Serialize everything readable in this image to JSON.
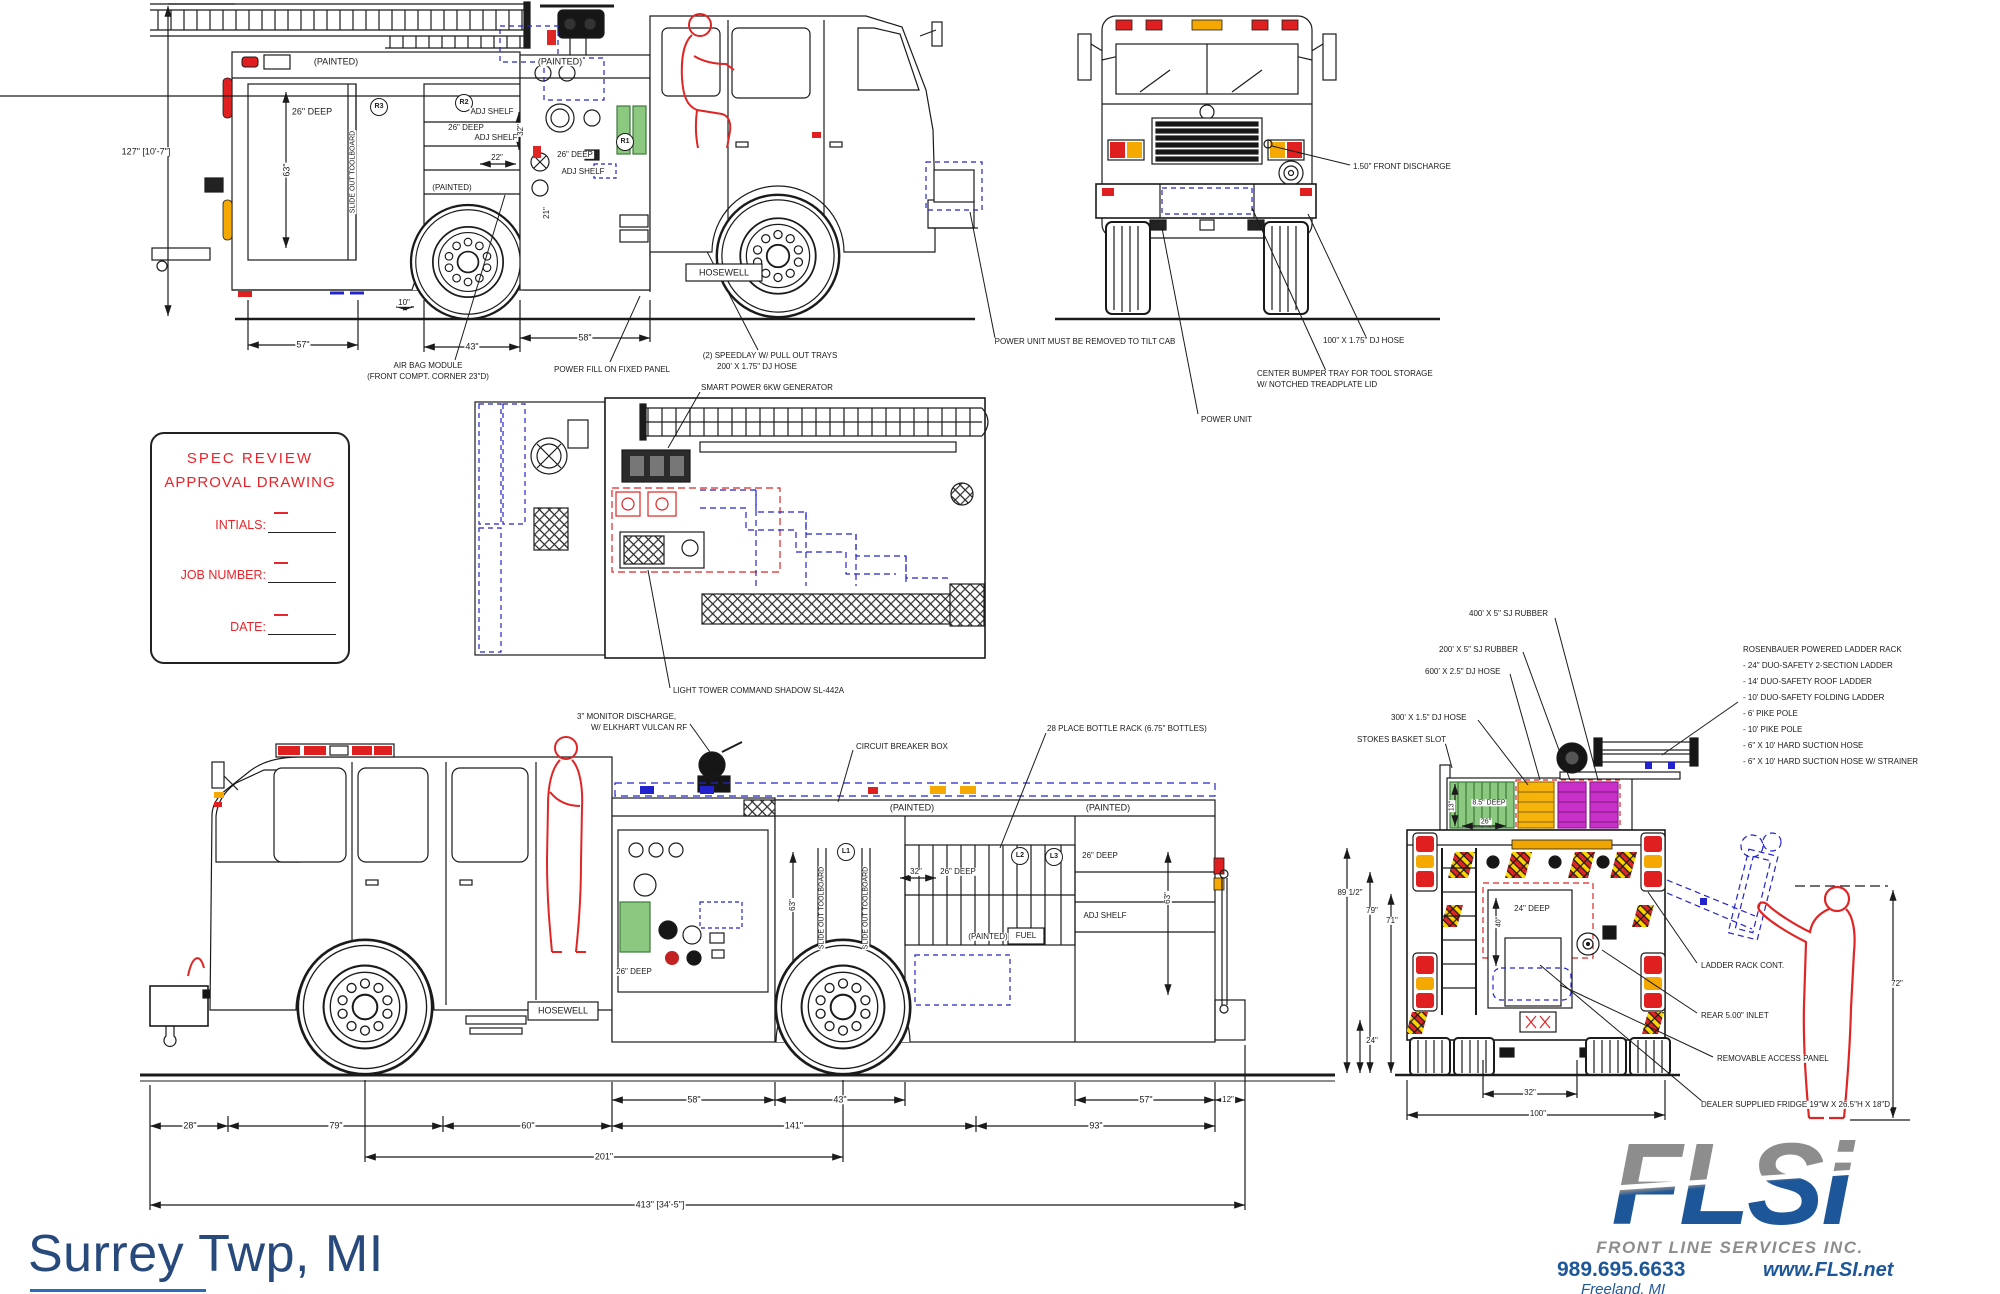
{
  "sheet": {
    "title": "Surrey Twp,  MI"
  },
  "spec_box": {
    "title1": "SPEC  REVIEW",
    "title2": "APPROVAL  DRAWING",
    "fields": [
      {
        "label": "INTIALS:"
      },
      {
        "label": "JOB  NUMBER:"
      },
      {
        "label": "DATE:"
      }
    ]
  },
  "logo": {
    "acronym": "FLSi",
    "company": "FRONT LINE SERVICES INC.",
    "phone": "989.695.6633",
    "website": "www.FLSI.net",
    "city": "Freeland, MI"
  },
  "colors": {
    "accent_red": "#e8252a",
    "cad_blue": "#2323cd",
    "hose_green": "#8cc87f",
    "hose_orange": "#f6b40a",
    "hose_magenta": "#c92fc9",
    "logo_blue": "#1e5799",
    "logo_gray": "#8d8d8d",
    "title_blue": "#27497c"
  },
  "labels": [
    {
      "t": "127\" [10'-7\"]",
      "x": 146,
      "y": 152
    },
    {
      "t": "(PAINTED)",
      "x": 336,
      "y": 62
    },
    {
      "t": "(PAINTED)",
      "x": 560,
      "y": 62
    },
    {
      "t": "26\" DEEP",
      "x": 312,
      "y": 112
    },
    {
      "t": "63\"",
      "x": 287,
      "y": 170,
      "r": -90
    },
    {
      "t": "SLIDE OUT TOOLBOARD",
      "x": 353,
      "y": 172,
      "r": -90,
      "fs": 7
    },
    {
      "t": "R3",
      "x": 379,
      "y": 107,
      "circ": 1,
      "fs": 7
    },
    {
      "t": "R2",
      "x": 464,
      "y": 103,
      "circ": 1,
      "fs": 7
    },
    {
      "t": "ADJ SHELF",
      "x": 492,
      "y": 112,
      "fs": 8
    },
    {
      "t": "26\" DEEP",
      "x": 466,
      "y": 128,
      "fs": 8
    },
    {
      "t": "ADJ SHELF",
      "x": 496,
      "y": 138,
      "fs": 8
    },
    {
      "t": "32\"",
      "x": 521,
      "y": 130,
      "r": -90,
      "fs": 8
    },
    {
      "t": "22\"",
      "x": 497,
      "y": 158,
      "fs": 8
    },
    {
      "t": "26\" DEEP",
      "x": 575,
      "y": 155,
      "fs": 8
    },
    {
      "t": "ADJ SHELF",
      "x": 583,
      "y": 172,
      "fs": 8
    },
    {
      "t": "(PAINTED)",
      "x": 452,
      "y": 188,
      "fs": 8
    },
    {
      "t": "21\"",
      "x": 547,
      "y": 213,
      "r": -90,
      "fs": 8
    },
    {
      "t": "R1",
      "x": 625,
      "y": 142,
      "circ": 1,
      "fs": 7
    },
    {
      "t": "10\"",
      "x": 404,
      "y": 303,
      "fs": 8
    },
    {
      "t": "57\"",
      "x": 303,
      "y": 345
    },
    {
      "t": "43\"",
      "x": 472,
      "y": 347
    },
    {
      "t": "58\"",
      "x": 585,
      "y": 338
    },
    {
      "t": "AIR BAG MODULE",
      "x": 428,
      "y": 366,
      "fs": 8
    },
    {
      "t": "(FRONT COMPT. CORNER 23\"D)",
      "x": 428,
      "y": 377,
      "fs": 8
    },
    {
      "t": "POWER FILL ON FIXED PANEL",
      "x": 612,
      "y": 370,
      "fs": 8
    },
    {
      "t": "HOSEWELL",
      "x": 724,
      "y": 273,
      "fs": 9
    },
    {
      "t": "(2) SPEEDLAY W/ PULL OUT TRAYS",
      "x": 770,
      "y": 356,
      "fs": 8
    },
    {
      "t": "200' X 1.75\" DJ HOSE",
      "x": 757,
      "y": 367,
      "fs": 8
    },
    {
      "t": "POWER UNIT MUST BE REMOVED TO TILT CAB",
      "x": 1085,
      "y": 342,
      "fs": 8
    },
    {
      "t": "1.50\" FRONT DISCHARGE",
      "x": 1352,
      "y": 167,
      "a": "l",
      "fs": 8
    },
    {
      "t": "100\" X 1.75\" DJ HOSE",
      "x": 1322,
      "y": 341,
      "a": "l",
      "fs": 8
    },
    {
      "t": "CENTER BUMPER TRAY FOR TOOL STORAGE",
      "x": 1256,
      "y": 374,
      "a": "l",
      "fs": 8
    },
    {
      "t": "W/ NOTCHED TREADPLATE LID",
      "x": 1256,
      "y": 385,
      "a": "l",
      "fs": 8
    },
    {
      "t": "POWER UNIT",
      "x": 1200,
      "y": 420,
      "a": "l",
      "fs": 8
    },
    {
      "t": "SMART POWER 6KW GENERATOR",
      "x": 700,
      "y": 388,
      "a": "l",
      "fs": 8
    },
    {
      "t": "LIGHT TOWER COMMAND SHADOW SL-442A",
      "x": 672,
      "y": 691,
      "a": "l",
      "fs": 8
    },
    {
      "t": "3\" MONITOR DISCHARGE,",
      "x": 576,
      "y": 717,
      "a": "l",
      "fs": 8
    },
    {
      "t": "W/ ELKHART VULCAN RF",
      "x": 590,
      "y": 728,
      "a": "l",
      "fs": 8
    },
    {
      "t": "CIRCUIT BREAKER BOX",
      "x": 855,
      "y": 747,
      "a": "l",
      "fs": 8
    },
    {
      "t": "28 PLACE BOTTLE RACK (6.75\" BOTTLES)",
      "x": 1046,
      "y": 729,
      "a": "l",
      "fs": 8
    },
    {
      "t": "(PAINTED)",
      "x": 912,
      "y": 808
    },
    {
      "t": "(PAINTED)",
      "x": 1108,
      "y": 808
    },
    {
      "t": "L1",
      "x": 846,
      "y": 852,
      "circ": 1,
      "fs": 7
    },
    {
      "t": "L2",
      "x": 1020,
      "y": 856,
      "circ": 1,
      "fs": 7
    },
    {
      "t": "L3",
      "x": 1054,
      "y": 857,
      "circ": 1,
      "fs": 7
    },
    {
      "t": "26\" DEEP",
      "x": 1100,
      "y": 856,
      "fs": 8
    },
    {
      "t": "ADJ SHELF",
      "x": 1105,
      "y": 916,
      "fs": 8
    },
    {
      "t": "63\"",
      "x": 793,
      "y": 905,
      "r": -90,
      "fs": 8
    },
    {
      "t": "63\"",
      "x": 1168,
      "y": 898,
      "r": -90,
      "fs": 8
    },
    {
      "t": "SLIDE OUT TOOLBOARD",
      "x": 822,
      "y": 908,
      "r": -90,
      "fs": 7
    },
    {
      "t": "SLIDE OUT TOOLBOARD",
      "x": 866,
      "y": 908,
      "r": -90,
      "fs": 7
    },
    {
      "t": "32\"",
      "x": 916,
      "y": 872,
      "fs": 8
    },
    {
      "t": "26\" DEEP",
      "x": 958,
      "y": 872,
      "fs": 8
    },
    {
      "t": "(PAINTED)",
      "x": 988,
      "y": 937,
      "fs": 8
    },
    {
      "t": "FUEL",
      "x": 1026,
      "y": 936,
      "fs": 8
    },
    {
      "t": "26\" DEEP",
      "x": 634,
      "y": 972,
      "fs": 8
    },
    {
      "t": "HOSEWELL",
      "x": 563,
      "y": 1011,
      "fs": 9
    },
    {
      "t": "58\"",
      "x": 694,
      "y": 1100
    },
    {
      "t": "43\"",
      "x": 840,
      "y": 1100
    },
    {
      "t": "57\"",
      "x": 1146,
      "y": 1100
    },
    {
      "t": "12\"",
      "x": 1228,
      "y": 1100,
      "fs": 8
    },
    {
      "t": "28\"",
      "x": 190,
      "y": 1126
    },
    {
      "t": "79\"",
      "x": 336,
      "y": 1126
    },
    {
      "t": "60\"",
      "x": 528,
      "y": 1126
    },
    {
      "t": "141\"",
      "x": 794,
      "y": 1126
    },
    {
      "t": "93\"",
      "x": 1096,
      "y": 1126
    },
    {
      "t": "201\"",
      "x": 604,
      "y": 1157
    },
    {
      "t": "413\" [34'-5\"]",
      "x": 660,
      "y": 1205
    },
    {
      "t": "400' X 5\" SJ RUBBER",
      "x": 1468,
      "y": 614,
      "a": "l",
      "fs": 8
    },
    {
      "t": "200' X 5\" SJ RUBBER",
      "x": 1438,
      "y": 650,
      "a": "l",
      "fs": 8
    },
    {
      "t": "600' X 2.5\" DJ HOSE",
      "x": 1424,
      "y": 672,
      "a": "l",
      "fs": 8
    },
    {
      "t": "300' X 1.5\" DJ HOSE",
      "x": 1390,
      "y": 718,
      "a": "l",
      "fs": 8
    },
    {
      "t": "STOKES BASKET SLOT",
      "x": 1356,
      "y": 740,
      "a": "l",
      "fs": 8
    },
    {
      "t": "ROSENBAUER POWERED LADDER RACK",
      "x": 1742,
      "y": 650,
      "a": "l",
      "fs": 8
    },
    {
      "t": "- 24\" DUO-SAFETY 2-SECTION LADDER",
      "x": 1742,
      "y": 666,
      "a": "l",
      "fs": 8
    },
    {
      "t": "- 14' DUO-SAFETY ROOF LADDER",
      "x": 1742,
      "y": 682,
      "a": "l",
      "fs": 8
    },
    {
      "t": "- 10' DUO-SAFETY FOLDING LADDER",
      "x": 1742,
      "y": 698,
      "a": "l",
      "fs": 8
    },
    {
      "t": "- 6' PIKE POLE",
      "x": 1742,
      "y": 714,
      "a": "l",
      "fs": 8
    },
    {
      "t": "- 10' PIKE POLE",
      "x": 1742,
      "y": 730,
      "a": "l",
      "fs": 8
    },
    {
      "t": "- 6\" X 10' HARD SUCTION HOSE",
      "x": 1742,
      "y": 746,
      "a": "l",
      "fs": 8
    },
    {
      "t": "- 6\" X 10' HARD SUCTION HOSE W/ STRAINER",
      "x": 1742,
      "y": 762,
      "a": "l",
      "fs": 8
    },
    {
      "t": "13\"",
      "x": 1452,
      "y": 806,
      "r": -90,
      "fs": 7
    },
    {
      "t": "8.5\" DEEP",
      "x": 1489,
      "y": 803,
      "fs": 7
    },
    {
      "t": "26\"",
      "x": 1486,
      "y": 822,
      "fs": 7
    },
    {
      "t": "89 1/2\"",
      "x": 1350,
      "y": 893,
      "fs": 8
    },
    {
      "t": "79\"",
      "x": 1372,
      "y": 911,
      "fs": 8
    },
    {
      "t": "71\"",
      "x": 1392,
      "y": 921,
      "fs": 8
    },
    {
      "t": "40\"",
      "x": 1499,
      "y": 922,
      "r": -90,
      "fs": 7
    },
    {
      "t": "24\" DEEP",
      "x": 1532,
      "y": 909,
      "fs": 8
    },
    {
      "t": "24\"",
      "x": 1372,
      "y": 1041,
      "fs": 8
    },
    {
      "t": "32\"",
      "x": 1530,
      "y": 1093,
      "fs": 8
    },
    {
      "t": "100\"",
      "x": 1538,
      "y": 1114,
      "fs": 8
    },
    {
      "t": "LADDER RACK CONT.",
      "x": 1700,
      "y": 966,
      "a": "l",
      "fs": 8
    },
    {
      "t": "REAR 5.00\" INLET",
      "x": 1700,
      "y": 1016,
      "a": "l",
      "fs": 8
    },
    {
      "t": "REMOVABLE ACCESS PANEL",
      "x": 1716,
      "y": 1059,
      "a": "l",
      "fs": 8
    },
    {
      "t": "DEALER SUPPLIED FRIDGE 19\"W X 26.5\"H X 18\"D",
      "x": 1700,
      "y": 1105,
      "a": "l",
      "fs": 8
    },
    {
      "t": "72\"",
      "x": 1897,
      "y": 984,
      "fs": 8
    }
  ]
}
